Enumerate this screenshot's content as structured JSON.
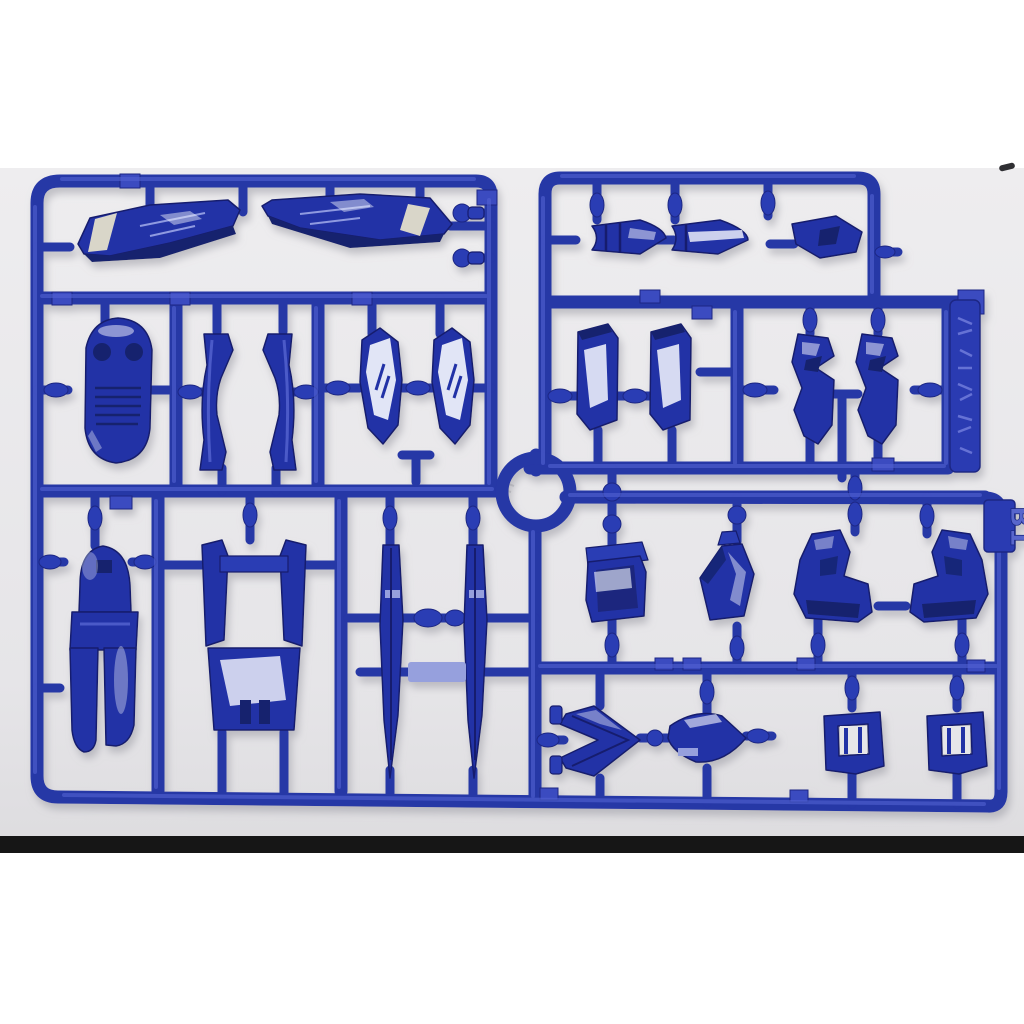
{
  "scene": {
    "type": "product-photo",
    "subject": "Blue injection-molded plastic model-kit runner (parts sprue) on a light gray surface",
    "orientation": "landscape photo letterboxed on white page"
  },
  "markings": {
    "runner_code": "B1",
    "tab_marking": "embossed manufacturer logotype (illegible)"
  },
  "colors": {
    "plastic_blue": "#2c3cb4",
    "plastic_shadow": "#1b2884",
    "plastic_highlight": "#5262d2",
    "background_gray": "#e9e9ec",
    "page_white": "#ffffff",
    "bottom_strip": "#161616",
    "wing_stripe": "#d9d6c9"
  },
  "parts": [
    {
      "name": "wing-binder-left",
      "zone": "top-left"
    },
    {
      "name": "wing-binder-right",
      "zone": "top-left"
    },
    {
      "name": "ball-joint-peg-upper",
      "zone": "top-center"
    },
    {
      "name": "ball-joint-peg-lower",
      "zone": "top-center"
    },
    {
      "name": "thruster-cone-left",
      "zone": "top-right"
    },
    {
      "name": "thruster-cone-center",
      "zone": "top-right"
    },
    {
      "name": "thruster-vane",
      "zone": "top-right"
    },
    {
      "name": "cockpit-hatch",
      "zone": "mid-left"
    },
    {
      "name": "leg-frame-left",
      "zone": "mid-left"
    },
    {
      "name": "leg-frame-right",
      "zone": "mid-left"
    },
    {
      "name": "claw-armor-left",
      "zone": "mid-center"
    },
    {
      "name": "claw-armor-right",
      "zone": "mid-center"
    },
    {
      "name": "shoulder-plate-left",
      "zone": "mid-right"
    },
    {
      "name": "shoulder-plate-right",
      "zone": "mid-right"
    },
    {
      "name": "ankle-guard-left",
      "zone": "mid-right"
    },
    {
      "name": "ankle-guard-right",
      "zone": "mid-right"
    },
    {
      "name": "backpack-housing",
      "zone": "bottom-left"
    },
    {
      "name": "waist-frame",
      "zone": "bottom-left"
    },
    {
      "name": "blade-fin-left",
      "zone": "bottom-left"
    },
    {
      "name": "blade-fin-right",
      "zone": "bottom-left"
    },
    {
      "name": "hip-box",
      "zone": "bottom-right"
    },
    {
      "name": "hex-armor-plate",
      "zone": "bottom-right"
    },
    {
      "name": "foot-left",
      "zone": "bottom-right"
    },
    {
      "name": "foot-right",
      "zone": "bottom-right"
    },
    {
      "name": "arrow-crest",
      "zone": "bottom-right"
    },
    {
      "name": "nose-cone-shield",
      "zone": "bottom-right"
    },
    {
      "name": "bracket-frame-left",
      "zone": "bottom-right"
    },
    {
      "name": "bracket-frame-right",
      "zone": "bottom-right"
    }
  ]
}
